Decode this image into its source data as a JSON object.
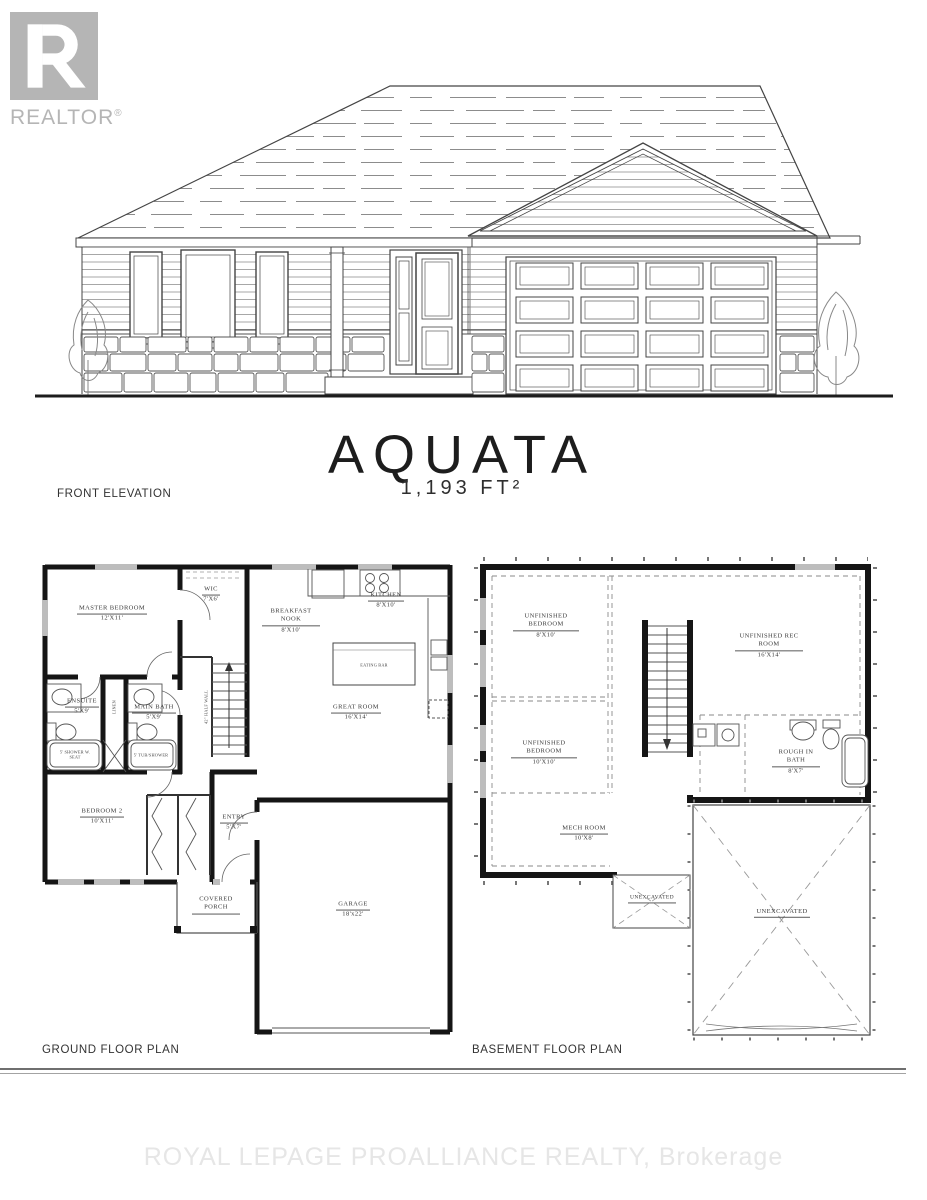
{
  "logo": {
    "brand": "REALTOR",
    "reg": "®"
  },
  "title": {
    "name": "AQUATA",
    "area": "1,193 FT²"
  },
  "sections": {
    "front_elevation": "FRONT ELEVATION",
    "ground_floor": "GROUND FLOOR PLAN",
    "basement_floor": "BASEMENT FLOOR PLAN"
  },
  "watermark": "ROYAL LEPAGE PROALLIANCE REALTY, Brokerage",
  "colors": {
    "logo_gray": "#b5b5b5",
    "wall_black": "#151515",
    "line_gray": "#555555",
    "watermark_gray": "#e6e6e6"
  },
  "ground": {
    "rooms": [
      {
        "name": "MASTER BEDROOM",
        "dim": "12'X11'"
      },
      {
        "name": "WIC",
        "dim": "7'X6'"
      },
      {
        "name": "BREAKFAST NOOK",
        "dim": "8'X10'"
      },
      {
        "name": "KITCHEN",
        "dim": "8'X10'"
      },
      {
        "name": "GREAT ROOM",
        "dim": "16'X14'"
      },
      {
        "name": "ENSUITE",
        "dim": "5'X9'"
      },
      {
        "name": "MAIN BATH",
        "dim": "5'X9'"
      },
      {
        "name": "BEDROOM 2",
        "dim": "10'X11'"
      },
      {
        "name": "ENTRY",
        "dim": "5'X7'"
      },
      {
        "name": "COVERED PORCH",
        "dim": ""
      },
      {
        "name": "GARAGE",
        "dim": "18'x22'"
      }
    ],
    "fixtures": {
      "eating_bar": "EATING BAR",
      "linen": "LINEN",
      "shower_seat": "5' SHOWER W. SEAT",
      "tub_shower": "5' TUB/SHOWER",
      "half_wall": "42\" HALF WALL"
    }
  },
  "basement": {
    "rooms": [
      {
        "name": "UNFINISHED BEDROOM",
        "dim": "8'X10'"
      },
      {
        "name": "UNFINISHED BEDROOM",
        "dim": "10'X10'"
      },
      {
        "name": "UNFINISHED REC ROOM",
        "dim": "16'X14'"
      },
      {
        "name": "ROUGH IN BATH",
        "dim": "8'X7'"
      },
      {
        "name": "MECH ROOM",
        "dim": "10'X8'"
      },
      {
        "name": "UNEXCAVATED",
        "dim": ""
      },
      {
        "name": "UNEXCAVATED",
        "dim": ""
      }
    ]
  }
}
